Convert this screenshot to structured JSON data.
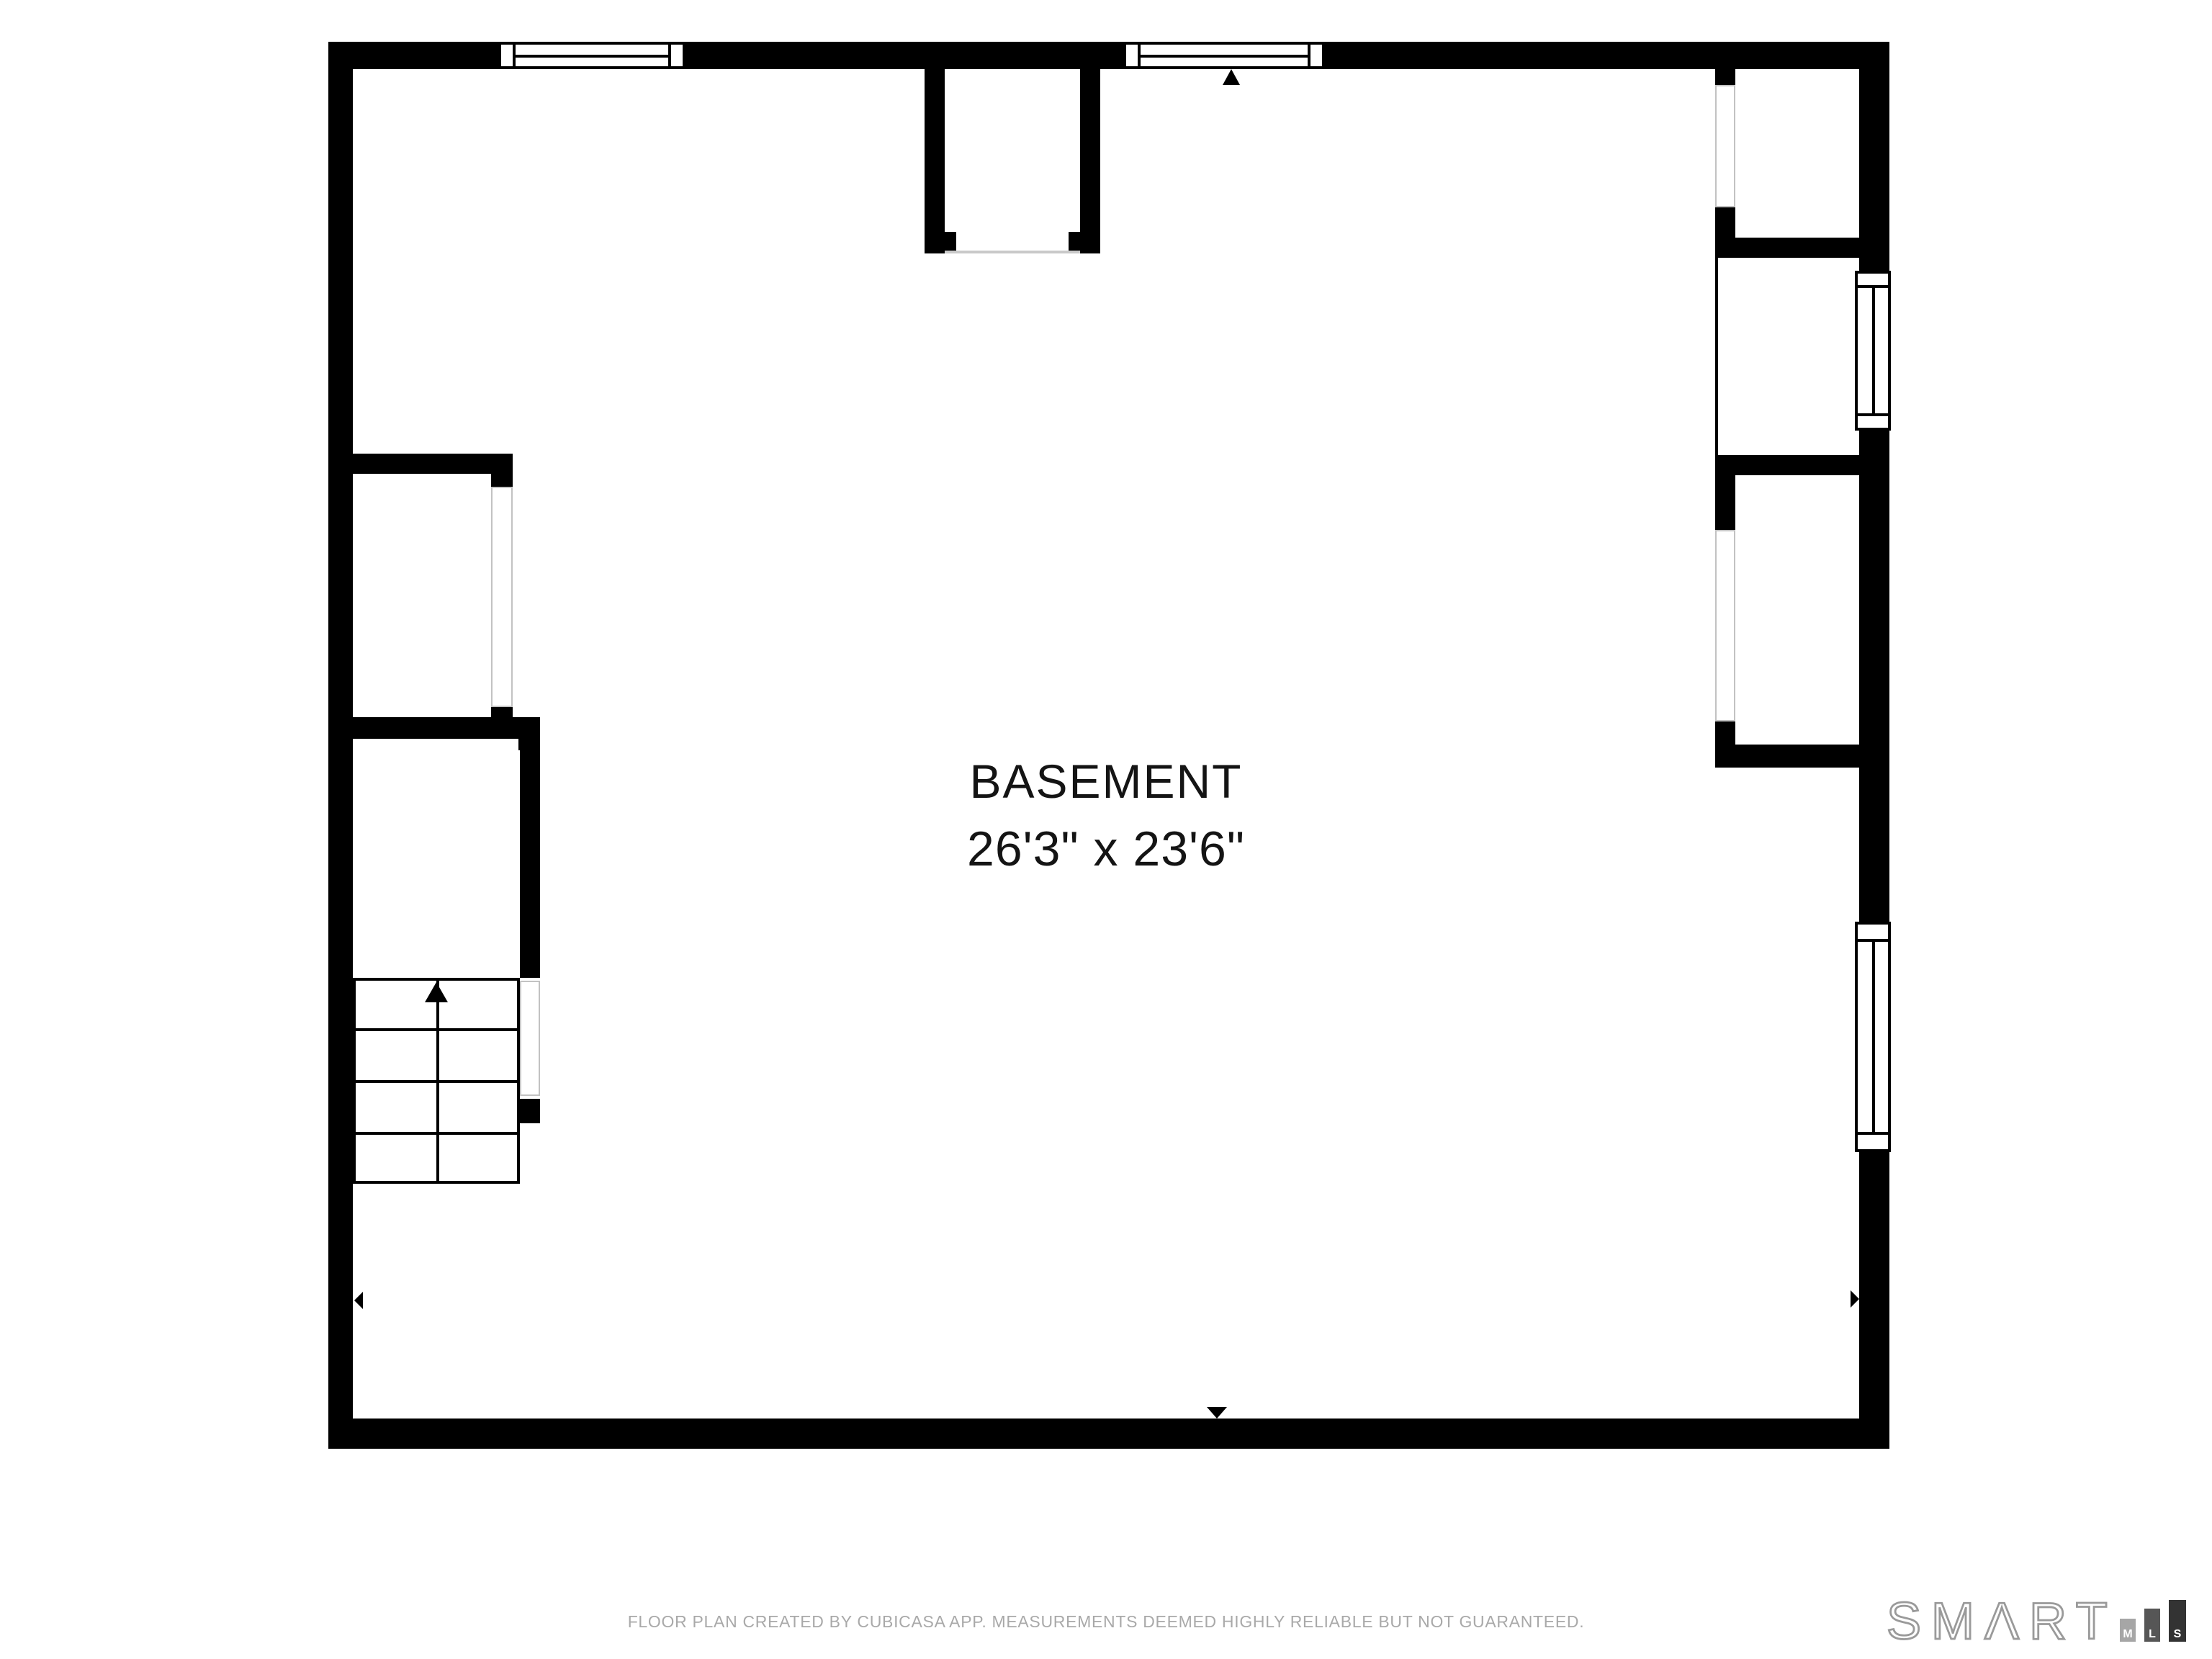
{
  "plan": {
    "label": "BASEMENT",
    "dimensions": "26'3\" x 23'6\""
  },
  "footer": {
    "disclaimer": "FLOOR PLAN CREATED BY CUBICASA APP. MEASUREMENTS DEEMED HIGHLY RELIABLE BUT NOT GUARANTEED."
  },
  "brand": {
    "logo_text": "SMΛRT",
    "mls": [
      {
        "letter": "M",
        "color": "#a6a6a6",
        "height": 16,
        "width": 11
      },
      {
        "letter": "L",
        "color": "#565656",
        "height": 23,
        "width": 11
      },
      {
        "letter": "S",
        "color": "#333333",
        "height": 29,
        "width": 12
      }
    ]
  },
  "colors": {
    "wall": "#000000",
    "door_outline": "#c2c2c2",
    "disclaimer_text": "#a9a9a9",
    "logo_outline": "#9a9a9a",
    "label_text": "#141414"
  },
  "icons": [
    "arrow-up-marker",
    "arrow-down-marker",
    "arrow-left-marker",
    "arrow-right-marker",
    "stairs-up-arrow"
  ]
}
